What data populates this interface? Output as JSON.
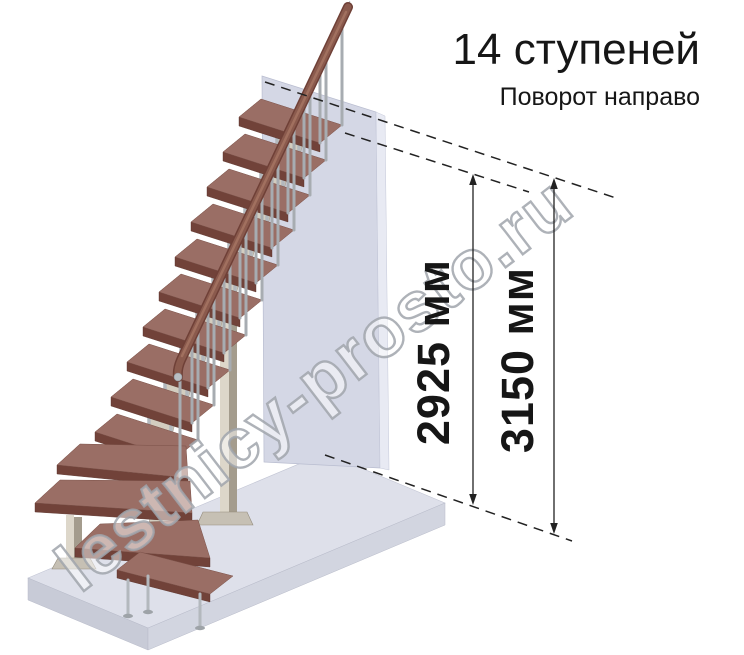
{
  "header": {
    "title": "14 ступеней",
    "subtitle": "Поворот направо"
  },
  "dimensions": {
    "inner": {
      "label": "2925 мм"
    },
    "outer": {
      "label": "3150 мм"
    }
  },
  "watermark": {
    "text": "lestnicy-prosto.ru"
  },
  "stairs": {
    "steps_total": "14"
  },
  "colors": {
    "background": "#ffffff",
    "text": "#161616",
    "dimension_line": "#222222",
    "wall": "#d4d7e5",
    "floor_top": "#dee0ea",
    "floor_front": "#c8cbd7",
    "tread_top": "#9a6e65",
    "tread_front": "#714239",
    "tread_side": "#5f352d",
    "handrail": "#8a5a4d",
    "metal": "#a7acb1",
    "tube_metal": "#b3b8bd",
    "support": "#d3cdc0",
    "watermark_outline": "#a0a4ac"
  }
}
